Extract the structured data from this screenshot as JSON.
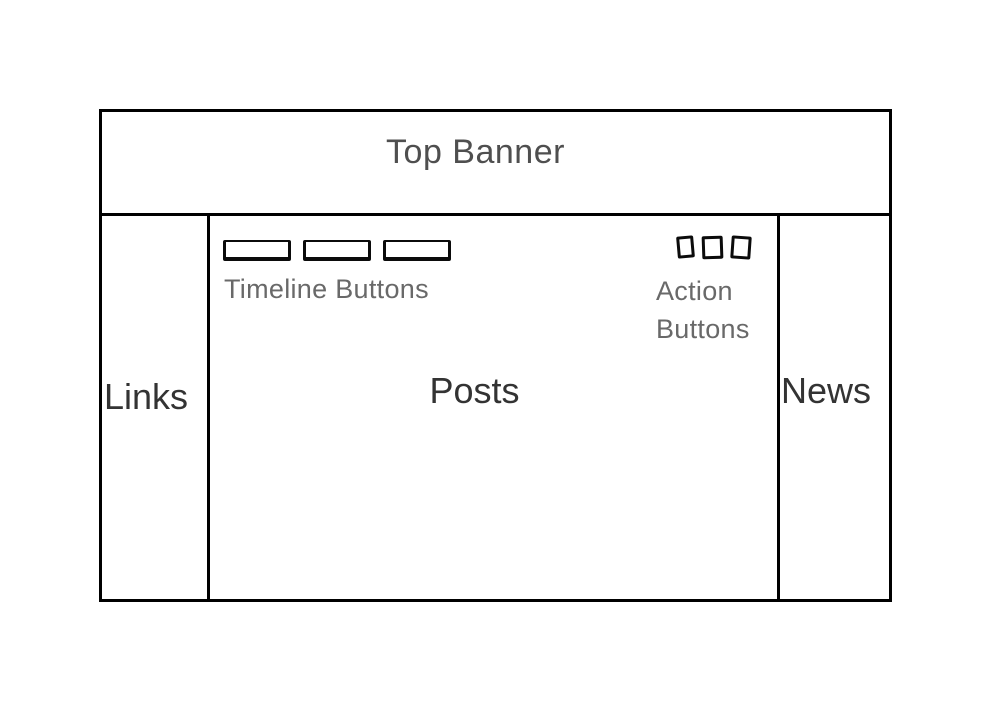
{
  "wireframe": {
    "top_banner": {
      "label": "Top Banner"
    },
    "sidebar_left": {
      "label": "Links"
    },
    "main": {
      "label": "Posts",
      "timeline_buttons": {
        "caption": "Timeline Buttons",
        "count": 3
      },
      "action_buttons": {
        "caption": "Action Buttons",
        "count": 3
      }
    },
    "sidebar_right": {
      "label": "News"
    }
  },
  "colors": {
    "line": "#000000",
    "background": "#ffffff",
    "banner_text": "#4f4f4f",
    "section_text": "#333333",
    "caption_text": "#696969"
  }
}
